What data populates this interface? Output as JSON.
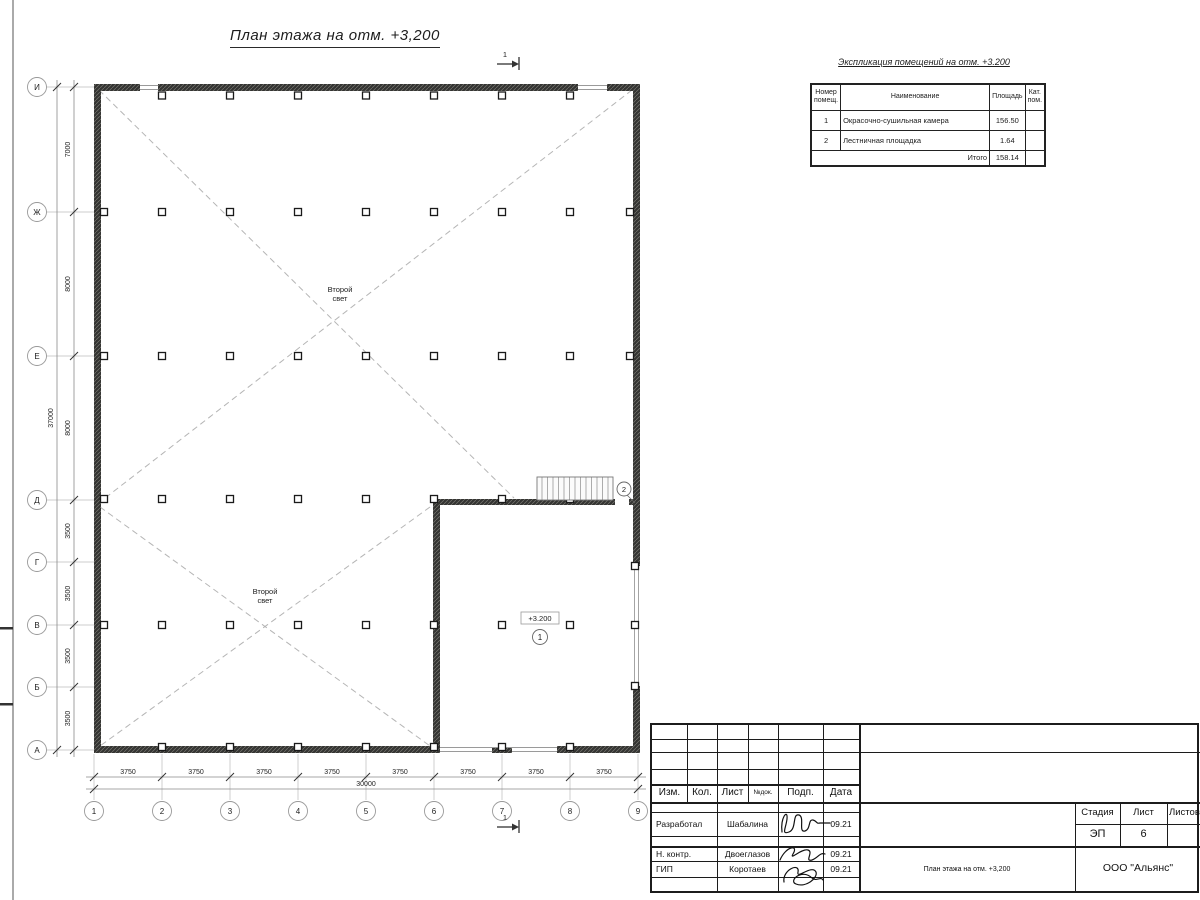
{
  "sheet": {
    "plan_title": "План этажа на отм. +3,200",
    "section_mark": "1"
  },
  "plan": {
    "void_line1": "Второй",
    "void_line2": "свет",
    "level_mark": "+3.200",
    "room_marks": {
      "r1": "1",
      "r2": "2"
    },
    "axes_left": [
      "И",
      "Ж",
      "Е",
      "Д",
      "Г",
      "В",
      "Б",
      "А"
    ],
    "axes_bottom": [
      "1",
      "2",
      "3",
      "4",
      "5",
      "6",
      "7",
      "8",
      "9"
    ],
    "dims_left": [
      "7000",
      "8000",
      "8000",
      "3500",
      "3500",
      "3500",
      "3500"
    ],
    "dim_left_total": "37000",
    "dims_bottom": [
      "3750",
      "3750",
      "3750",
      "3750",
      "3750",
      "3750",
      "3750",
      "3750"
    ],
    "dim_bottom_total": "30000"
  },
  "expl": {
    "title": "Экспликация помещений на отм. +3.200",
    "headers": {
      "num": "Номер\nпомещ.",
      "name": "Наименование",
      "area": "Площадь",
      "cat": "Кат.\nпом."
    },
    "rows": [
      {
        "num": "1",
        "name": "Окрасочно-сушильная камера",
        "area": "156.50",
        "cat": ""
      },
      {
        "num": "2",
        "name": "Лестничная площадка",
        "area": "1.64",
        "cat": ""
      }
    ],
    "total_label": "Итого",
    "total_area": "158.14"
  },
  "titleblock": {
    "header": [
      "Изм.",
      "Кол.",
      "Лист",
      "№док.",
      "Подп.",
      "Дата"
    ],
    "rows": [
      {
        "role": "Разработал",
        "name": "Шабалина",
        "date": "09.21"
      },
      {
        "role": "Н. контр.",
        "name": "Двоеглазов",
        "date": "09.21"
      },
      {
        "role": "ГИП",
        "name": "Коротаев",
        "date": "09.21"
      }
    ],
    "stage_label": "Стадия",
    "sheet_label": "Лист",
    "sheets_label": "Листов",
    "stage": "ЭП",
    "sheet_no": "6",
    "doc_name": "План этажа на отм. +3,200",
    "company": "ООО \"Альянс\""
  }
}
